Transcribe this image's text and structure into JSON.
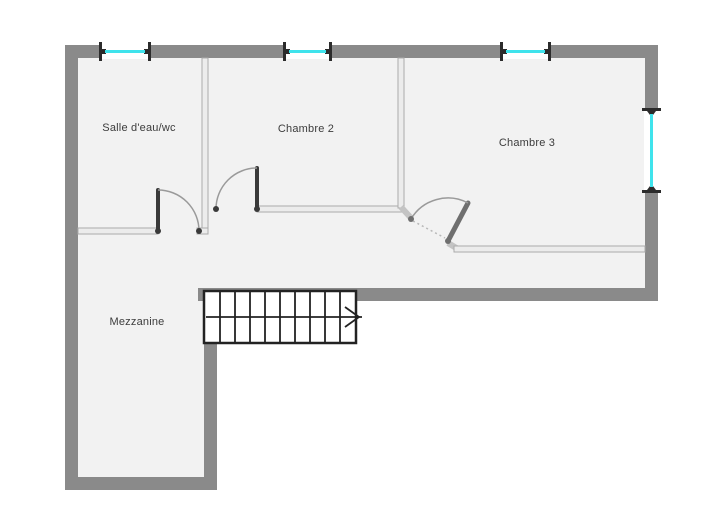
{
  "rooms": {
    "salle_eau": {
      "label": "Salle d'eau/wc"
    },
    "chambre2": {
      "label": "Chambre 2"
    },
    "chambre3": {
      "label": "Chambre 3"
    },
    "mezzanine": {
      "label": "Mezzanine"
    }
  },
  "colors": {
    "background": "#ffffff",
    "floor": "#f2f2f2",
    "exterior_wall": "#8a8a8a",
    "interior_wall_fill": "#ececec",
    "interior_wall_edge": "#ababab",
    "interior_wall_diag": "#c4c4c4",
    "door_leaf": "#3a3a3a",
    "door_leaf_light": "#6f6f6f",
    "door_arc": "#9a9a9a",
    "window_glass": "#3fe3ec",
    "window_frame": "#2b2b2b",
    "stair_stroke": "#222222",
    "label_text": "#3c3c3c"
  }
}
